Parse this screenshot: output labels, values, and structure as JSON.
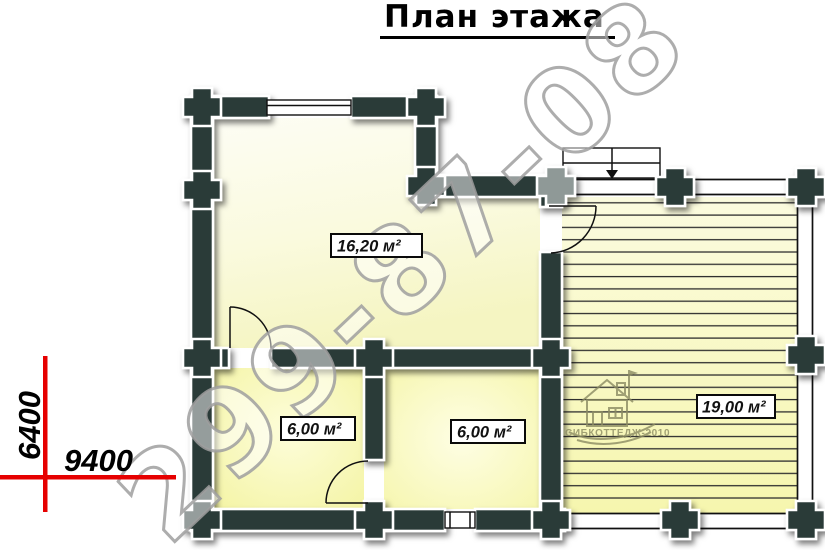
{
  "title": "План этажа",
  "dimension_labels": {
    "height": "6400",
    "width": "9400"
  },
  "rooms": [
    {
      "name": "main-room",
      "area_label": "16,20 м²"
    },
    {
      "name": "room-bottom-left",
      "area_label": "6,00 м²"
    },
    {
      "name": "room-bottom-middle",
      "area_label": "6,00 м²"
    },
    {
      "name": "terrace",
      "area_label": "19,00 м²"
    }
  ],
  "watermark_phone": "299-87-08",
  "logo_text": "СИБКОТТЕДЖ-2010",
  "colors": {
    "wall": "#2b3a38",
    "dimension_line": "#e60000",
    "room_fill_yellow": "#f7f7b0",
    "watermark_outline": "#9f9f9f",
    "logo_olive": "#8a8a62"
  }
}
